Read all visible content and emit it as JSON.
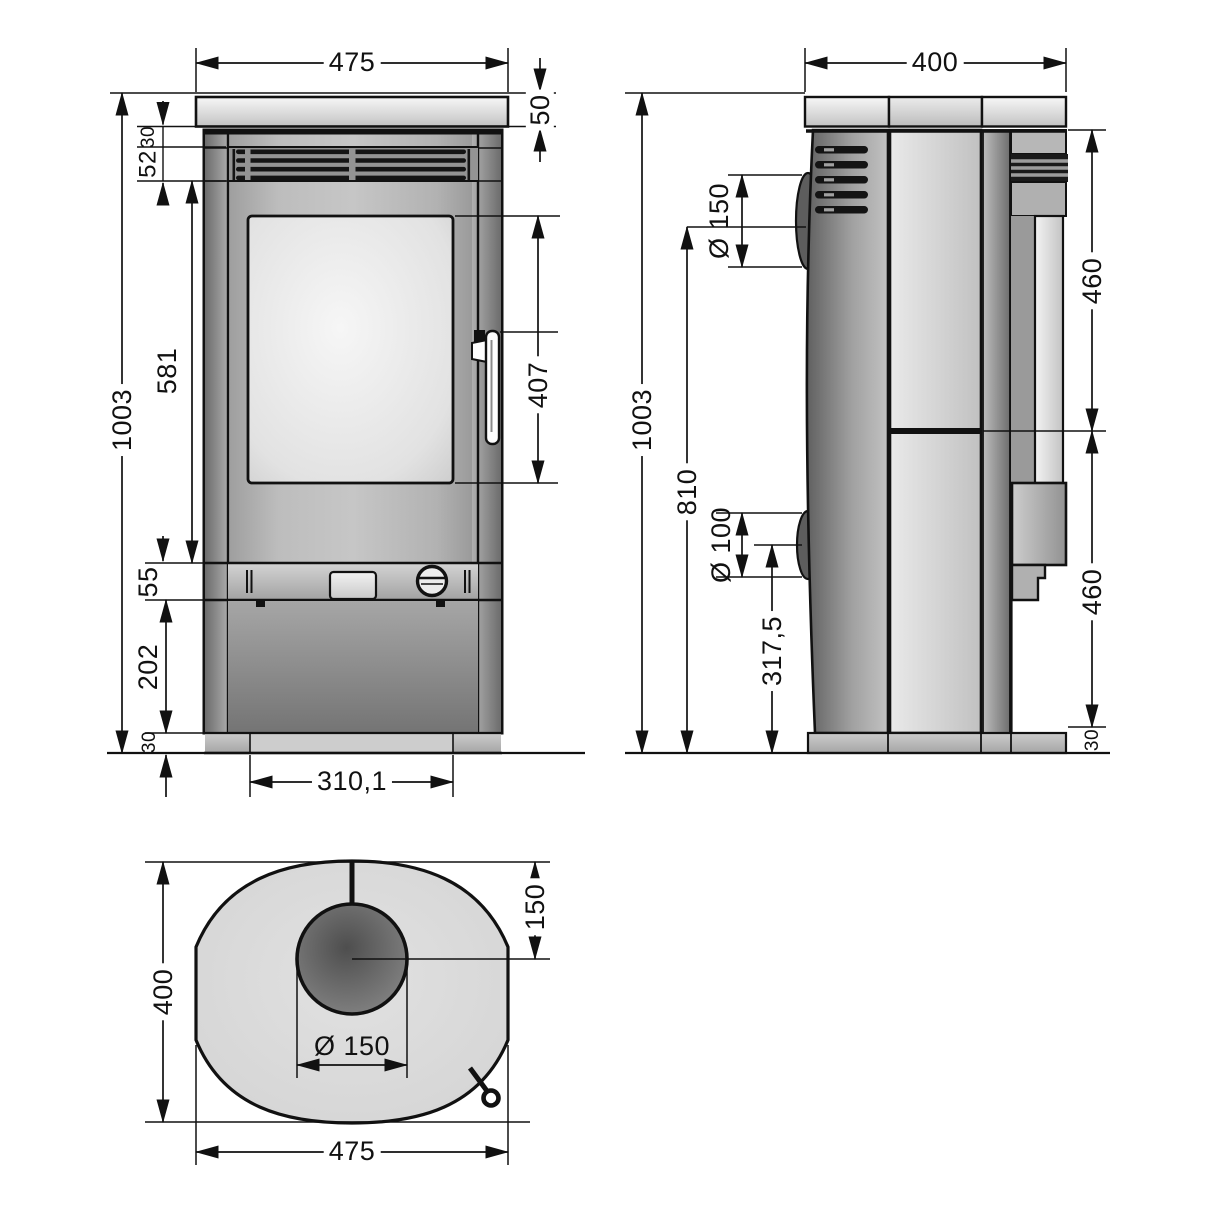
{
  "front_view": {
    "width_top": "475",
    "top_plate_thickness": "50",
    "gap_below_plate": "30",
    "vent_height": "52",
    "total_height": "1003",
    "upper_section": "581",
    "glass_door_height": "407",
    "control_strip": "55",
    "base_height": "202",
    "plinth_height": "30",
    "plinth_width": "310,1"
  },
  "side_view": {
    "depth_top": "400",
    "total_height": "1003",
    "flue_center_height": "810",
    "flue_diameter": "Ø 150",
    "rear_outlet_diameter": "Ø 100",
    "rear_outlet_height": "317,5",
    "upper_panel": "460",
    "lower_panel": "460",
    "plinth_height": "30"
  },
  "top_view": {
    "depth": "400",
    "flue_center_from_back": "150",
    "flue_diameter": "Ø 150",
    "width": "475"
  },
  "colors": {
    "line": "#111111",
    "body_gray": "#a9a9a9",
    "light_gray": "#e3e3e3",
    "background": "#ffffff"
  }
}
